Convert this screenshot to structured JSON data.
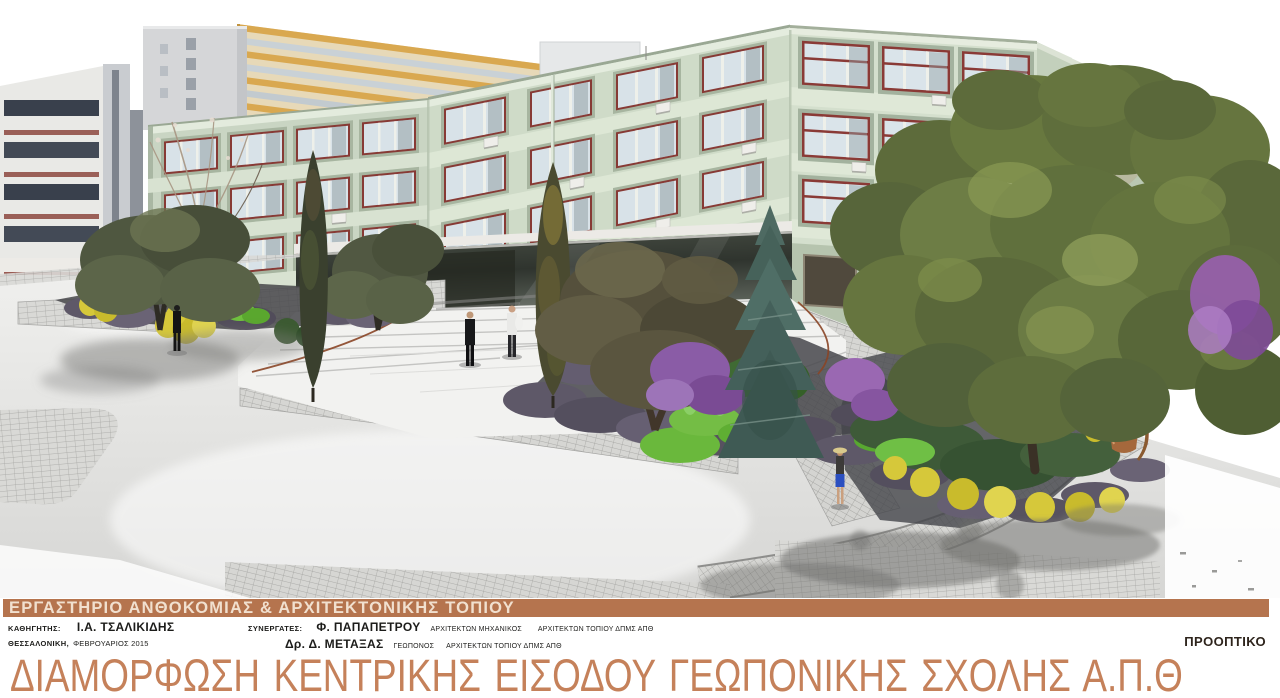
{
  "banner": {
    "text": "ΕΡΓΑΣΤΗΡΙΟ ΑΝΘΟΚΟΜΙΑΣ & ΑΡΧΙΤΕΚΤΟΝΙΚΗΣ ΤΟΠΙΟΥ",
    "bg_color": "#b5744e",
    "text_color": "#f1e0cf"
  },
  "credits": {
    "professor_label": "ΚΑΘΗΓΗΤΗΣ:",
    "professor_name": "Ι.Α. ΤΣΑΛΙΚΙΔΗΣ",
    "place": "ΘΕΣΣΑΛΟΝΙΚΗ,",
    "date": "ΦΕΒΡΟΥΑΡΙΟΣ 2015",
    "collaborators_label": "ΣΥΝΕΡΓΑΤΕΣ:",
    "collaborators": [
      {
        "name": "Φ. ΠΑΠΑΠΕΤΡΟΥ",
        "title_a": "ΑΡΧΙΤΕΚΤΩΝ ΜΗΧΑΝΙΚΟΣ",
        "title_b": "ΑΡΧΙΤΕΚΤΩΝ ΤΟΠΙΟΥ ΔΠΜΣ ΑΠΘ"
      },
      {
        "name": "Δρ. Δ. ΜΕΤΑΞΑΣ",
        "title_a": "ΓΕΩΠΟΝΟΣ",
        "title_b": "ΑΡΧΙΤΕΚΤΩΝ ΤΟΠΙΟΥ ΔΠΜΣ ΑΠΘ"
      }
    ],
    "view_label": "ΠΡΟΟΠΤΙΚΟ"
  },
  "main_title": {
    "text": "ΔΙΑΜΟΡΦΩΣΗ ΚΕΝΤΡΙΚΗΣ ΕΙΣΟΔΟΥ ΓΕΩΠΟΝΙΚΗΣ ΣΧΟΛΗΣ Α.Π.Θ",
    "color": "#c5815a"
  },
  "scene": {
    "palette": {
      "building_facade": "#cfdbc8",
      "window_frame": "#873a35",
      "ochre_building": "#d9a850",
      "paving_grid": "#d9d9d6",
      "road": "#e9e9e7",
      "lavender_shrub": "#5e5868",
      "yellow_shrub": "#d6c83a",
      "purple_shrub": "#8a5ca6",
      "glass_entrance": "#3a403a"
    }
  }
}
